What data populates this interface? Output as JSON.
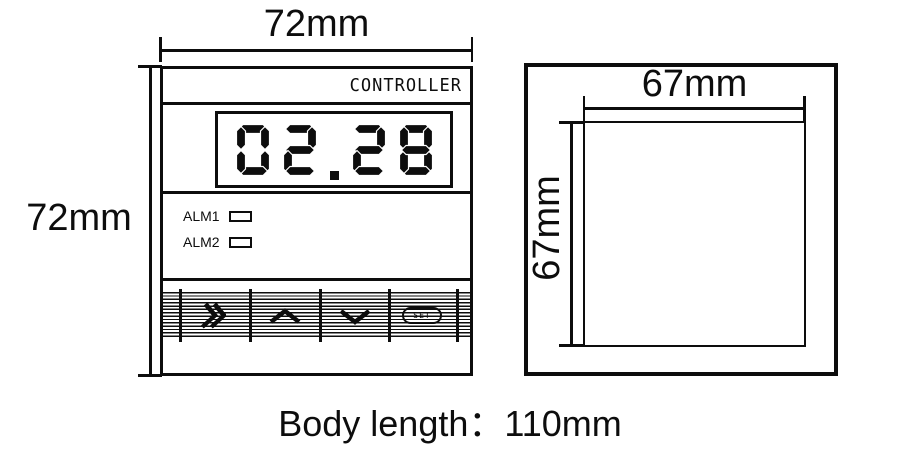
{
  "front_view": {
    "width_dim": "72mm",
    "height_dim": "72mm",
    "brand_text": "CONTROLLER",
    "display_value": "02.28",
    "indicators": [
      {
        "label": "ALM1"
      },
      {
        "label": "ALM2"
      }
    ],
    "buttons": [
      {
        "name": "shift",
        "icon": "double-chevron-right-icon"
      },
      {
        "name": "up",
        "icon": "chevron-up-icon"
      },
      {
        "name": "down",
        "icon": "chevron-down-icon"
      },
      {
        "name": "set",
        "label": "SET"
      }
    ]
  },
  "side_view": {
    "width_dim": "67mm",
    "height_dim": "67mm"
  },
  "caption": "Body length：110mm",
  "colors": {
    "line": "#0d0d0d",
    "background": "#ffffff"
  }
}
